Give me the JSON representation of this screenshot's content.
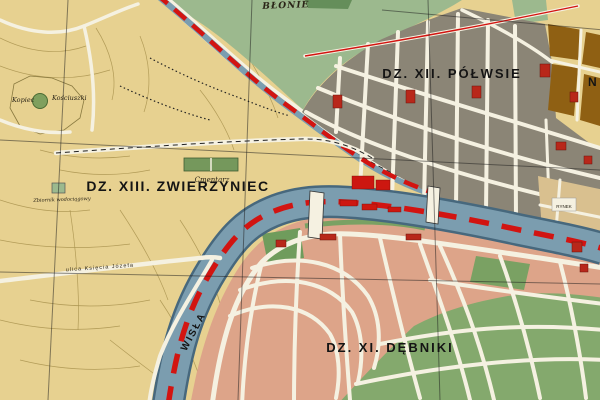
{
  "map": {
    "type": "historical-city-district-map",
    "labels": {
      "blonie": "BŁONIE",
      "polwsie": "DZ. XII. PÓŁWSIE",
      "zwierzyniec": "DZ. XIII. ZWIERZYNIEC",
      "debniki": "DZ. XI. DĘBNIKI",
      "wisla": "WISŁA",
      "rynek": "RYNEK",
      "kopiec_left": "Kopiec",
      "kopiec_right": "Kościuszki",
      "cmentarz": "Cmentarz",
      "zbiornik": "Zbiornik wodociągowy",
      "ulica_jozefa": "ulica Księcia Józefa",
      "partial_right_edge": "N"
    },
    "colors": {
      "land_tan": "#e7d190",
      "meadow_green": "#9cb98e",
      "meadow_dark": "#5f8a54",
      "district_gray": "#8b8576",
      "district_pink": "#dda489",
      "park_green": "#6f9c5c",
      "field_green": "#84a96d",
      "water_blue": "#7b9daf",
      "water_edge": "#47687d",
      "boundary_red": "#d21411",
      "building_red": "#b8271a",
      "building_bright_red": "#cd1710",
      "brown_blocks": "#8f6013",
      "road_white": "#f5f1e1",
      "grid_black": "#1c1c1c"
    }
  }
}
